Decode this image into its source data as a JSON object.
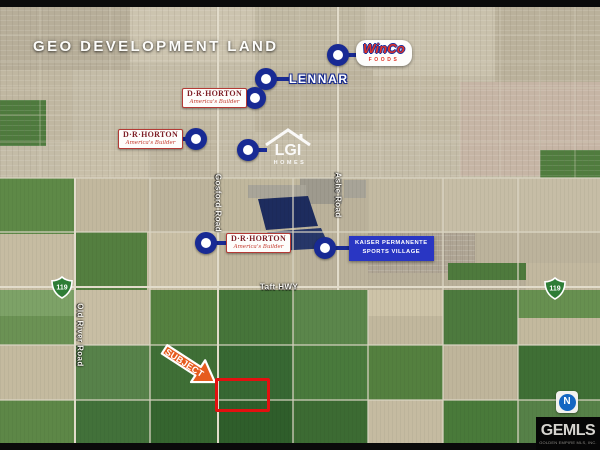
{
  "title": "GEO DEVELOPMENT LAND",
  "labels": {
    "winco": {
      "line1": "WinCo",
      "line2": "FOODS"
    },
    "lennar": {
      "text": "LENNAR"
    },
    "drhorton": {
      "line1": "D·R·HORTON",
      "line2": "America's Builder"
    },
    "lgi": {
      "line1": "LGI",
      "line2": "HOMES"
    },
    "kaiser": {
      "line1": "KAISER PERMANENTE",
      "line2": "SPORTS VILLAGE"
    }
  },
  "roads": {
    "gosford": "Gosford Road",
    "ashe": "Ashe Road",
    "taft": "Taft HWY",
    "old_river": "Old River Road"
  },
  "shields": {
    "left": "119",
    "right": "119"
  },
  "subject_label": "SUBJECT",
  "compass_letter": "N",
  "watermark": {
    "name": "GEMLS",
    "subtitle": "GOLDEN EMPIRE MLS, INC."
  },
  "colors": {
    "marker_blue": "#182a94",
    "kaiser_blue": "#2936c3",
    "horton_red": "#7e1f26",
    "winco_red": "#e03226",
    "subject_orange": "#e65c1e",
    "parcel_red": "#e31010",
    "shield_green": "#2e7d36"
  }
}
